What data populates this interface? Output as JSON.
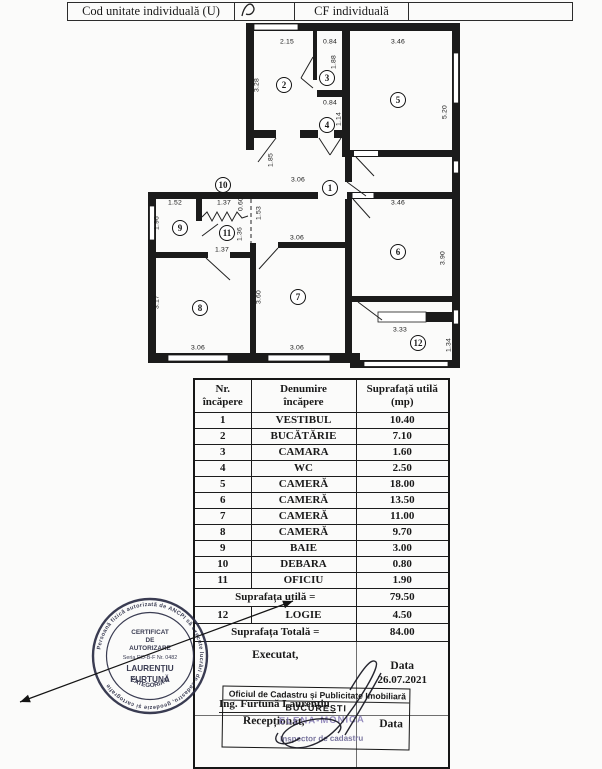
{
  "colors": {
    "ink": "#1a1a1a",
    "stamp_ink": "#2a2c44",
    "inspector_ink": "#7b6fae"
  },
  "header_row": {
    "cells": [
      {
        "label": "Cod unitate individuală (U)"
      },
      {
        "label": ""
      },
      {
        "label": "CF individuală"
      },
      {
        "label": ""
      }
    ]
  },
  "plan": {
    "dimension_labels": [
      {
        "text": "2.15",
        "x": 147,
        "y": 22
      },
      {
        "text": "0.84",
        "x": 190,
        "y": 22
      },
      {
        "text": "3.46",
        "x": 258,
        "y": 22
      },
      {
        "text": "3.28",
        "x": 117,
        "y": 65,
        "v": true
      },
      {
        "text": "1.88",
        "x": 194,
        "y": 42,
        "v": true
      },
      {
        "text": "5.20",
        "x": 305,
        "y": 92,
        "v": true
      },
      {
        "text": "0.84",
        "x": 190,
        "y": 83
      },
      {
        "text": "1.14",
        "x": 199,
        "y": 99,
        "v": true
      },
      {
        "text": "1.85",
        "x": 131,
        "y": 140,
        "v": true
      },
      {
        "text": "3.06",
        "x": 158,
        "y": 160
      },
      {
        "text": "1.52",
        "x": 35,
        "y": 183
      },
      {
        "text": "1.37",
        "x": 84,
        "y": 183
      },
      {
        "text": "0.60",
        "x": 101,
        "y": 184,
        "v": true
      },
      {
        "text": "1.53",
        "x": 119,
        "y": 193,
        "v": true
      },
      {
        "text": "1.96",
        "x": 17,
        "y": 203,
        "v": true
      },
      {
        "text": "1.36",
        "x": 100,
        "y": 214,
        "v": true
      },
      {
        "text": "1.37",
        "x": 82,
        "y": 230
      },
      {
        "text": "3.06",
        "x": 157,
        "y": 218
      },
      {
        "text": "3.46",
        "x": 258,
        "y": 183
      },
      {
        "text": "3.90",
        "x": 303,
        "y": 238,
        "v": true
      },
      {
        "text": "3.17",
        "x": 17,
        "y": 282,
        "v": true
      },
      {
        "text": "3.60",
        "x": 119,
        "y": 277,
        "v": true
      },
      {
        "text": "3.06",
        "x": 58,
        "y": 328
      },
      {
        "text": "3.06",
        "x": 157,
        "y": 328
      },
      {
        "text": "3.33",
        "x": 260,
        "y": 310
      },
      {
        "text": "1.34",
        "x": 309,
        "y": 325,
        "v": true
      }
    ],
    "room_numbers": [
      {
        "n": "1",
        "x": 190,
        "y": 168
      },
      {
        "n": "2",
        "x": 144,
        "y": 65
      },
      {
        "n": "3",
        "x": 187,
        "y": 58
      },
      {
        "n": "4",
        "x": 187,
        "y": 105
      },
      {
        "n": "5",
        "x": 258,
        "y": 80
      },
      {
        "n": "6",
        "x": 258,
        "y": 232
      },
      {
        "n": "7",
        "x": 158,
        "y": 277
      },
      {
        "n": "8",
        "x": 60,
        "y": 288
      },
      {
        "n": "9",
        "x": 40,
        "y": 208
      },
      {
        "n": "10",
        "x": 83,
        "y": 165
      },
      {
        "n": "11",
        "x": 87,
        "y": 213
      },
      {
        "n": "12",
        "x": 278,
        "y": 323
      }
    ]
  },
  "table": {
    "headers": [
      {
        "l1": "Nr.",
        "l2": "încăpere"
      },
      {
        "l1": "Denumire",
        "l2": "încăpere"
      },
      {
        "l1": "Suprafață utilă",
        "l2": "(mp)"
      }
    ],
    "rows": [
      {
        "nr": "1",
        "name": "VESTIBUL",
        "area": "10.40"
      },
      {
        "nr": "2",
        "name": "BUCĂTĂRIE",
        "area": "7.10"
      },
      {
        "nr": "3",
        "name": "CAMARA",
        "area": "1.60"
      },
      {
        "nr": "4",
        "name": "WC",
        "area": "2.50"
      },
      {
        "nr": "5",
        "name": "CAMERĂ",
        "area": "18.00"
      },
      {
        "nr": "6",
        "name": "CAMERĂ",
        "area": "13.50"
      },
      {
        "nr": "7",
        "name": "CAMERĂ",
        "area": "11.00"
      },
      {
        "nr": "8",
        "name": "CAMERĂ",
        "area": "9.70"
      },
      {
        "nr": "9",
        "name": "BAIE",
        "area": "3.00"
      },
      {
        "nr": "10",
        "name": "DEBARA",
        "area": "0.80"
      },
      {
        "nr": "11",
        "name": "OFICIU",
        "area": "1.90"
      }
    ],
    "subtotal": {
      "label": "Suprafața utilă =",
      "value": "79.50"
    },
    "row12": {
      "nr": "12",
      "name": "LOGIE",
      "area": "4.50"
    },
    "total": {
      "label": "Suprafața Totală =",
      "value": "84.00"
    }
  },
  "signoff": {
    "executed_label": "Executat,",
    "engineer": "Ing. Furtună Laurențiu",
    "date_label": "Data",
    "date": "26.07.2021"
  },
  "office_box": {
    "office": "Oficiul de Cadastru și Publicitate Imobiliară",
    "city": "BUCUREȘTI",
    "received_label": "Recepționat,",
    "inspector_stamp_name": "ELENA-MONICA",
    "inspector_title": "Inspector de cadastru",
    "date_label": "Data"
  },
  "stamp": {
    "ring_text": "Persoană fizică autorizată de ANCPI să execute lucrări de cadastru, geodezie și cartografie",
    "line1": "CERTIFICAT",
    "line2": "DE",
    "line3": "AUTORIZARE",
    "line4": "Seria RO-B-F Nr. 0482",
    "line5": "LAURENȚIU",
    "line6": "FURTUNĂ",
    "category": "CATEGORIA D"
  }
}
